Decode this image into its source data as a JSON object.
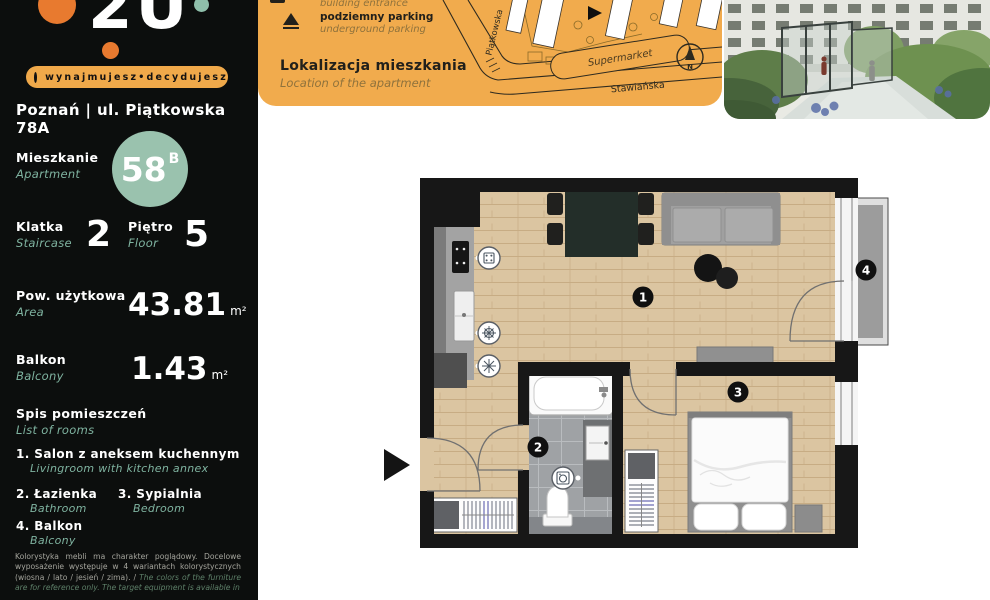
{
  "brand": {
    "logo_text": "2U",
    "tagline": "wynajmujesz•decydujesz"
  },
  "sidebar": {
    "address": "Poznań | ul. Piątkowska 78A",
    "apartment": {
      "label_pl": "Mieszkanie",
      "label_en": "Apartment",
      "number": "58",
      "suffix": "B"
    },
    "staircase": {
      "label_pl": "Klatka",
      "label_en": "Staircase",
      "value": "2"
    },
    "floor": {
      "label_pl": "Piętro",
      "label_en": "Floor",
      "value": "5"
    },
    "area": {
      "label_pl": "Pow. użytkowa",
      "label_en": "Area",
      "value": "43.81",
      "unit": "m²"
    },
    "balcony": {
      "label_pl": "Balkon",
      "label_en": "Balcony",
      "value": "1.43",
      "unit": "m²"
    },
    "rooms": {
      "title_pl": "Spis pomieszczeń",
      "title_en": "List of rooms",
      "items": [
        {
          "num": "1.",
          "pl": "Salon z aneksem kuchennym",
          "en": "Livingroom with kitchen annex"
        },
        {
          "num": "2.",
          "pl": "Łazienka",
          "en": "Bathroom"
        },
        {
          "num": "3.",
          "pl": "Sypialnia",
          "en": "Bedroom"
        },
        {
          "num": "4.",
          "pl": "Balkon",
          "en": "Balcony"
        }
      ]
    },
    "footnote_pl": "Kolorystyka mebli ma charakter poglądowy. Docelowe wyposażenie występuje w 4 wariantach kolorystycznych (wiosna / lato / jesień / zima). / ",
    "footnote_en": "The colors of the furniture are for reference only. The target equipment is available in"
  },
  "legend": {
    "entrance_en": "building entrance",
    "parking_pl": "podziemny parking",
    "parking_en": "underground parking",
    "location_pl": "Lokalizacja mieszkania",
    "location_en": "Location of the apartment"
  },
  "map": {
    "supermarket": "Supermarket",
    "street_bottom": "Stawiańska",
    "street_left": "Piątkowska",
    "compass_n": "N"
  },
  "plan": {
    "labels": {
      "living": "1",
      "bathroom": "2",
      "bedroom": "3",
      "balcony": "4"
    }
  },
  "colors": {
    "sidebar_bg": "#0C0E0D",
    "accent_orange": "#F1AB4D",
    "accent_teal": "#9AC2AE",
    "teal_text": "#7FB3A0",
    "wall_black": "#171717",
    "wood_floor": "#DBC5A1"
  }
}
